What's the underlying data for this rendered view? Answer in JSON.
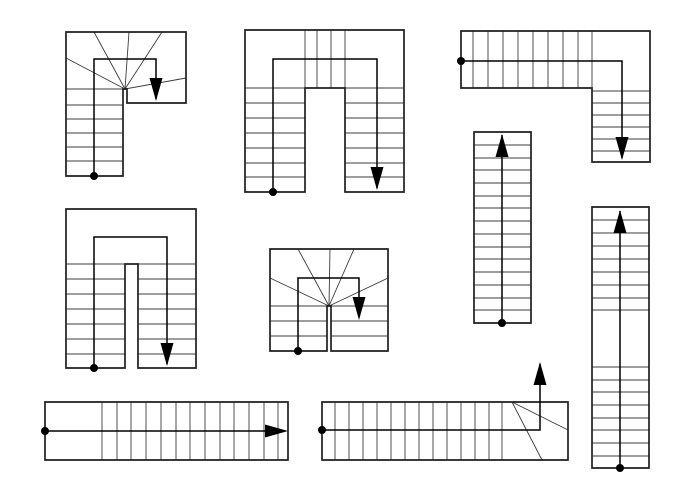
{
  "canvas": {
    "width": 700,
    "height": 500,
    "background": "#ffffff",
    "line_color": "#1f1f1f",
    "tread_color": "#3c3c3c",
    "walk_color": "#000000",
    "dot_radius": 4,
    "arrow_length": 23,
    "arrow_half_width": 6.5
  },
  "stairs": [
    {
      "id": "stair-1-half-turn-winder",
      "kind": "half-turn winder, arrow down",
      "outline": [
        [
          66,
          32
        ],
        [
          186,
          32
        ],
        [
          186,
          103
        ],
        [
          127,
          103
        ],
        [
          127,
          89
        ],
        [
          123,
          89
        ],
        [
          123,
          176
        ],
        [
          66,
          176
        ]
      ],
      "treads": [
        [
          125,
          89,
          66,
          58
        ],
        [
          125,
          89,
          94,
          32
        ],
        [
          125,
          89,
          129,
          32
        ],
        [
          125,
          89,
          162,
          32
        ],
        [
          125,
          89,
          186,
          78
        ],
        [
          66,
          89,
          125,
          89
        ],
        [
          66,
          105,
          123,
          105
        ],
        [
          66,
          119,
          123,
          119
        ],
        [
          66,
          133,
          123,
          133
        ],
        [
          66,
          147,
          123,
          147
        ],
        [
          66,
          161,
          123,
          161
        ]
      ],
      "walkline": [
        [
          94,
          176
        ],
        [
          94,
          59
        ],
        [
          156,
          59
        ],
        [
          156,
          99
        ]
      ],
      "dot": [
        94,
        176
      ],
      "arrow": {
        "tip": [
          156,
          101
        ],
        "dir": "down"
      }
    },
    {
      "id": "stair-2-u-shape-winder-top",
      "kind": "half-turn with treads across top, arrow down",
      "outline": [
        [
          245,
          30
        ],
        [
          404,
          30
        ],
        [
          404,
          192
        ],
        [
          345,
          192
        ],
        [
          345,
          88
        ],
        [
          305,
          88
        ],
        [
          305,
          192
        ],
        [
          245,
          192
        ]
      ],
      "treads": [
        [
          245,
          88,
          404,
          88
        ],
        [
          305,
          30,
          305,
          88
        ],
        [
          317,
          30,
          317,
          88
        ],
        [
          331,
          30,
          331,
          88
        ],
        [
          345,
          30,
          345,
          88
        ],
        [
          245,
          103,
          305,
          103
        ],
        [
          245,
          118,
          305,
          118
        ],
        [
          245,
          133,
          305,
          133
        ],
        [
          245,
          148,
          305,
          148
        ],
        [
          245,
          163,
          305,
          163
        ],
        [
          245,
          177,
          305,
          177
        ],
        [
          345,
          103,
          404,
          103
        ],
        [
          345,
          118,
          404,
          118
        ],
        [
          345,
          133,
          404,
          133
        ],
        [
          345,
          148,
          404,
          148
        ],
        [
          345,
          163,
          404,
          163
        ],
        [
          345,
          177,
          404,
          177
        ]
      ],
      "walkline": [
        [
          273,
          192
        ],
        [
          273,
          59
        ],
        [
          377,
          59
        ],
        [
          377,
          188
        ]
      ],
      "dot": [
        273,
        192
      ],
      "arrow": {
        "tip": [
          377,
          190
        ],
        "dir": "down"
      }
    },
    {
      "id": "stair-3-quarter-turn-l",
      "kind": "L-shaped quarter turn, arrow down",
      "outline": [
        [
          461,
          31
        ],
        [
          650,
          31
        ],
        [
          650,
          162
        ],
        [
          592,
          162
        ],
        [
          592,
          88
        ],
        [
          461,
          88
        ]
      ],
      "treads": [
        [
          473,
          31,
          473,
          88
        ],
        [
          488,
          31,
          488,
          88
        ],
        [
          503,
          31,
          503,
          88
        ],
        [
          518,
          31,
          518,
          88
        ],
        [
          533,
          31,
          533,
          88
        ],
        [
          548,
          31,
          548,
          88
        ],
        [
          563,
          31,
          563,
          88
        ],
        [
          578,
          31,
          578,
          88
        ],
        [
          592,
          31,
          592,
          88
        ],
        [
          592,
          91,
          650,
          91
        ],
        [
          592,
          103,
          650,
          103
        ],
        [
          592,
          115,
          650,
          115
        ],
        [
          592,
          127,
          650,
          127
        ],
        [
          592,
          139,
          650,
          139
        ],
        [
          592,
          151,
          650,
          151
        ]
      ],
      "walkline": [
        [
          461,
          61
        ],
        [
          622,
          61
        ],
        [
          622,
          158
        ]
      ],
      "dot": [
        461,
        61
      ],
      "arrow": {
        "tip": [
          622,
          160
        ],
        "dir": "down"
      }
    },
    {
      "id": "stair-4-u-shape-landing-top",
      "kind": "half-turn with top landing and narrow well, arrow down",
      "outline": [
        [
          66,
          209
        ],
        [
          196,
          209
        ],
        [
          196,
          368
        ],
        [
          138,
          368
        ],
        [
          138,
          264
        ],
        [
          125,
          264
        ],
        [
          125,
          368
        ],
        [
          66,
          368
        ]
      ],
      "treads": [
        [
          66,
          264,
          196,
          264
        ],
        [
          66,
          279,
          125,
          279
        ],
        [
          66,
          294,
          125,
          294
        ],
        [
          66,
          309,
          125,
          309
        ],
        [
          66,
          324,
          125,
          324
        ],
        [
          66,
          339,
          125,
          339
        ],
        [
          66,
          354,
          125,
          354
        ],
        [
          138,
          279,
          196,
          279
        ],
        [
          138,
          294,
          196,
          294
        ],
        [
          138,
          309,
          196,
          309
        ],
        [
          138,
          324,
          196,
          324
        ],
        [
          138,
          339,
          196,
          339
        ],
        [
          138,
          354,
          196,
          354
        ]
      ],
      "walkline": [
        [
          94,
          368
        ],
        [
          94,
          237
        ],
        [
          167,
          237
        ],
        [
          167,
          364
        ]
      ],
      "dot": [
        94,
        368
      ],
      "arrow": {
        "tip": [
          167,
          366
        ],
        "dir": "down"
      }
    },
    {
      "id": "stair-5-double-winder",
      "kind": "compact half-turn winder, arrow down",
      "outline": [
        [
          270,
          249
        ],
        [
          388,
          249
        ],
        [
          388,
          351
        ],
        [
          331,
          351
        ],
        [
          331,
          306
        ],
        [
          327,
          306
        ],
        [
          327,
          351
        ],
        [
          270,
          351
        ]
      ],
      "treads": [
        [
          329,
          306,
          270,
          278
        ],
        [
          329,
          306,
          298,
          249
        ],
        [
          329,
          306,
          330,
          249
        ],
        [
          329,
          306,
          354,
          249
        ],
        [
          329,
          306,
          388,
          278
        ],
        [
          270,
          306,
          388,
          306
        ],
        [
          270,
          321,
          327,
          321
        ],
        [
          270,
          336,
          327,
          336
        ],
        [
          331,
          321,
          388,
          321
        ],
        [
          331,
          336,
          388,
          336
        ]
      ],
      "walkline": [
        [
          298,
          351
        ],
        [
          298,
          278
        ],
        [
          359,
          278
        ],
        [
          359,
          317
        ]
      ],
      "dot": [
        298,
        351
      ],
      "arrow": {
        "tip": [
          359,
          320
        ],
        "dir": "down"
      }
    },
    {
      "id": "stair-6-straight-up",
      "kind": "straight flight, arrow up",
      "outline": [
        [
          474,
          132
        ],
        [
          531,
          132
        ],
        [
          531,
          323
        ],
        [
          474,
          323
        ]
      ],
      "treads": [
        [
          474,
          145,
          531,
          145
        ],
        [
          474,
          158,
          531,
          158
        ],
        [
          474,
          170,
          531,
          170
        ],
        [
          474,
          183,
          531,
          183
        ],
        [
          474,
          196,
          531,
          196
        ],
        [
          474,
          208,
          531,
          208
        ],
        [
          474,
          221,
          531,
          221
        ],
        [
          474,
          234,
          531,
          234
        ],
        [
          474,
          247,
          531,
          247
        ],
        [
          474,
          259,
          531,
          259
        ],
        [
          474,
          272,
          531,
          272
        ],
        [
          474,
          285,
          531,
          285
        ],
        [
          474,
          298,
          531,
          298
        ],
        [
          474,
          310,
          531,
          310
        ]
      ],
      "walkline": [
        [
          502,
          323
        ],
        [
          502,
          135
        ]
      ],
      "dot": [
        502,
        323
      ],
      "arrow": {
        "tip": [
          502,
          134
        ],
        "dir": "up"
      }
    },
    {
      "id": "stair-7-straight-with-landing",
      "kind": "straight flight with mid landing, arrow up",
      "outline": [
        [
          592,
          207
        ],
        [
          649,
          207
        ],
        [
          649,
          468
        ],
        [
          592,
          468
        ]
      ],
      "treads": [
        [
          592,
          220,
          649,
          220
        ],
        [
          592,
          233,
          649,
          233
        ],
        [
          592,
          246,
          649,
          246
        ],
        [
          592,
          259,
          649,
          259
        ],
        [
          592,
          272,
          649,
          272
        ],
        [
          592,
          285,
          649,
          285
        ],
        [
          592,
          298,
          649,
          298
        ],
        [
          592,
          310,
          649,
          310
        ],
        [
          592,
          367,
          649,
          367
        ],
        [
          592,
          380,
          649,
          380
        ],
        [
          592,
          392,
          649,
          392
        ],
        [
          592,
          405,
          649,
          405
        ],
        [
          592,
          418,
          649,
          418
        ],
        [
          592,
          430,
          649,
          430
        ],
        [
          592,
          443,
          649,
          443
        ],
        [
          592,
          456,
          649,
          456
        ]
      ],
      "walkline": [
        [
          620,
          468
        ],
        [
          620,
          211
        ]
      ],
      "dot": [
        620,
        468
      ],
      "arrow": {
        "tip": [
          620,
          210
        ],
        "dir": "up"
      }
    },
    {
      "id": "stair-8-straight-right",
      "kind": "straight flight with entry landing, arrow right",
      "outline": [
        [
          45,
          402
        ],
        [
          288,
          402
        ],
        [
          288,
          460
        ],
        [
          45,
          460
        ]
      ],
      "treads": [
        [
          102,
          402,
          102,
          460
        ],
        [
          117,
          402,
          117,
          460
        ],
        [
          131,
          402,
          131,
          460
        ],
        [
          146,
          402,
          146,
          460
        ],
        [
          161,
          402,
          161,
          460
        ],
        [
          176,
          402,
          176,
          460
        ],
        [
          190,
          402,
          190,
          460
        ],
        [
          205,
          402,
          205,
          460
        ],
        [
          220,
          402,
          220,
          460
        ],
        [
          234,
          402,
          234,
          460
        ],
        [
          249,
          402,
          249,
          460
        ],
        [
          264,
          402,
          264,
          460
        ],
        [
          278,
          402,
          278,
          460
        ]
      ],
      "walkline": [
        [
          45,
          431
        ],
        [
          285,
          431
        ]
      ],
      "dot": [
        45,
        431
      ],
      "arrow": {
        "tip": [
          288,
          431
        ],
        "dir": "right"
      }
    },
    {
      "id": "stair-9-straight-with-exit-winder",
      "kind": "straight flight with winder exit, arrow up",
      "outline": [
        [
          322,
          402
        ],
        [
          568,
          402
        ],
        [
          568,
          460
        ],
        [
          322,
          460
        ]
      ],
      "treads": [
        [
          335,
          402,
          335,
          460
        ],
        [
          349,
          402,
          349,
          460
        ],
        [
          363,
          402,
          363,
          460
        ],
        [
          377,
          402,
          377,
          460
        ],
        [
          391,
          402,
          391,
          460
        ],
        [
          405,
          402,
          405,
          460
        ],
        [
          419,
          402,
          419,
          460
        ],
        [
          433,
          402,
          433,
          460
        ],
        [
          447,
          402,
          447,
          460
        ],
        [
          461,
          402,
          461,
          460
        ],
        [
          475,
          402,
          475,
          460
        ],
        [
          489,
          402,
          489,
          460
        ],
        [
          502,
          402,
          502,
          460
        ],
        [
          512,
          402,
          568,
          430
        ],
        [
          512,
          402,
          542,
          460
        ]
      ],
      "walkline": [
        [
          322,
          430
        ],
        [
          540,
          430
        ],
        [
          540,
          364
        ]
      ],
      "dot": [
        322,
        430
      ],
      "arrow": {
        "tip": [
          540,
          362
        ],
        "dir": "up"
      }
    }
  ]
}
